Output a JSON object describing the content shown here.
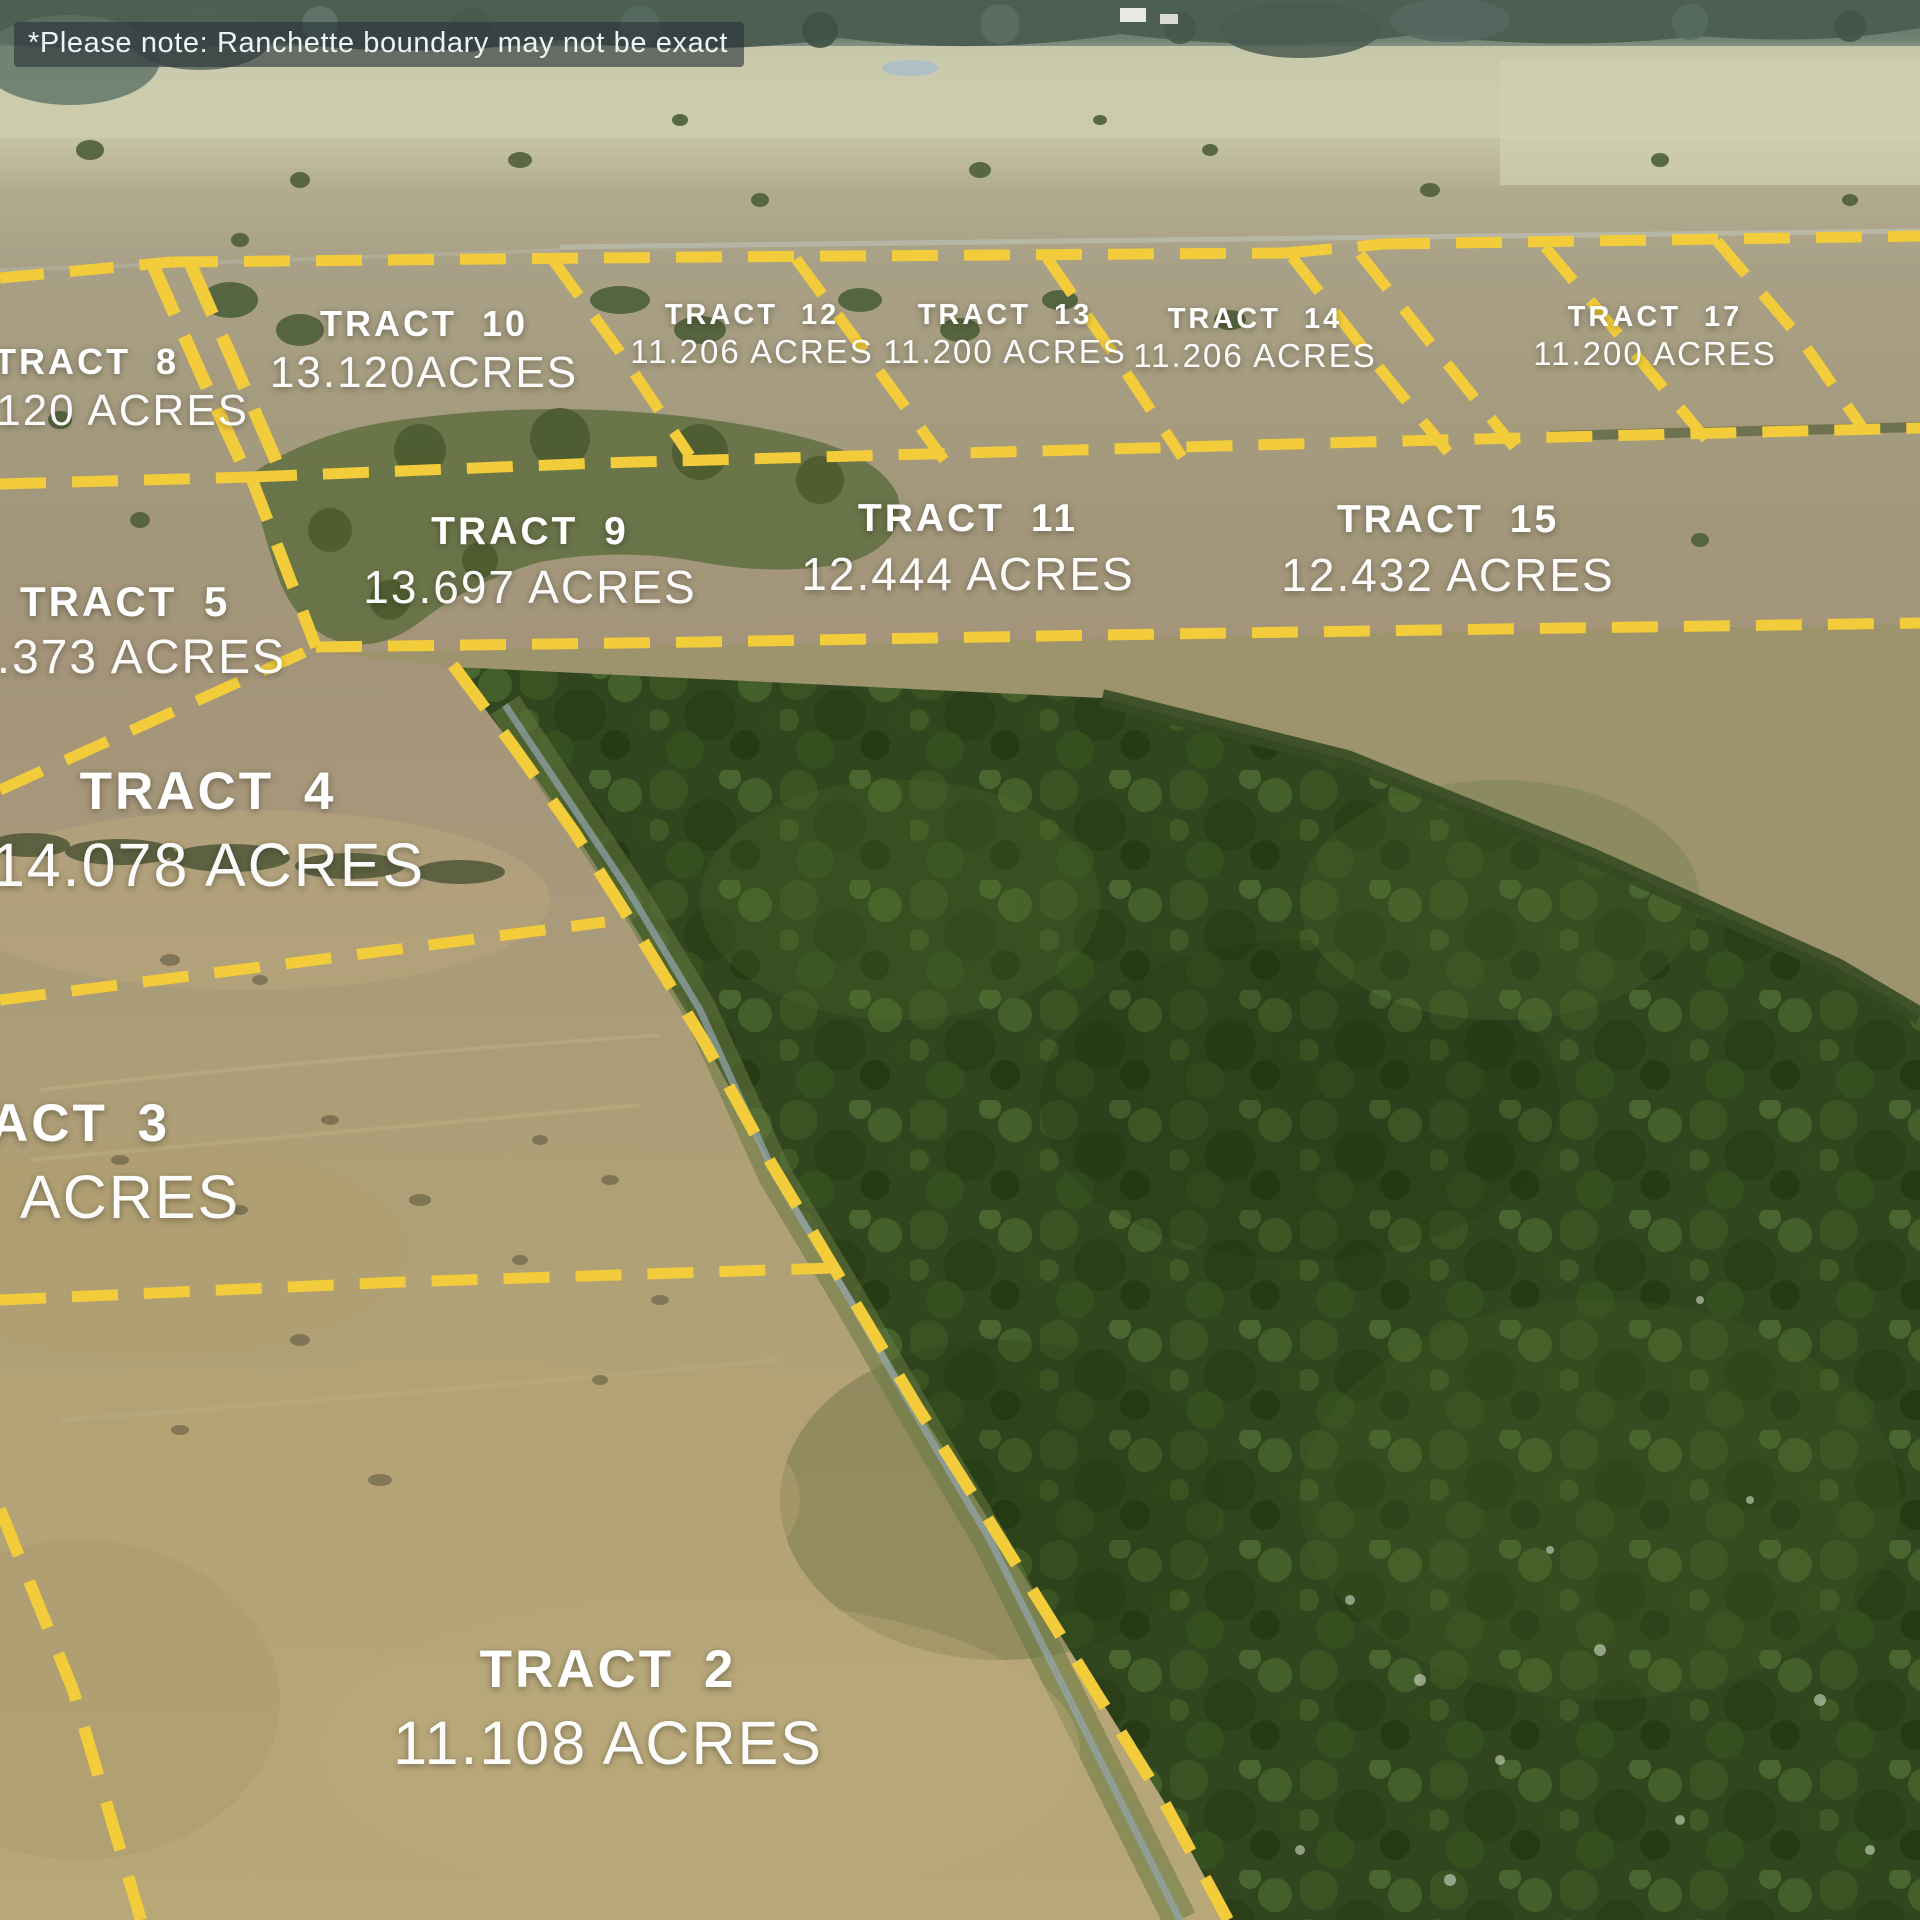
{
  "disclaimer": "*Please note: Ranchette boundary may not be exact",
  "boundary_color": "#F2CC3A",
  "tracts": [
    {
      "id": "tract-2",
      "name": "TRACT 2",
      "acres": "11.108 ACRES"
    },
    {
      "id": "tract-3",
      "name": "ACT 3",
      "acres": "ACRES"
    },
    {
      "id": "tract-4",
      "name": "TRACT 4",
      "acres": "14.078 ACRES"
    },
    {
      "id": "tract-5",
      "name": "TRACT 5",
      "acres": "2.373 ACRES"
    },
    {
      "id": "tract-8",
      "name": "TRACT 8",
      "acres": ".120 ACRES"
    },
    {
      "id": "tract-9",
      "name": "TRACT 9",
      "acres": "13.697 ACRES"
    },
    {
      "id": "tract-10",
      "name": "TRACT 10",
      "acres": "13.120ACRES"
    },
    {
      "id": "tract-11",
      "name": "TRACT 11",
      "acres": "12.444 ACRES"
    },
    {
      "id": "tract-12",
      "name": "TRACT 12",
      "acres": "11.206 ACRES"
    },
    {
      "id": "tract-13",
      "name": "TRACT 13",
      "acres": "11.200 ACRES"
    },
    {
      "id": "tract-14",
      "name": "TRACT 14",
      "acres": "11.206 ACRES"
    },
    {
      "id": "tract-15",
      "name": "TRACT 15",
      "acres": "12.432 ACRES"
    },
    {
      "id": "tract-17",
      "name": "TRACT 17",
      "acres": "11.200 ACRES"
    }
  ]
}
